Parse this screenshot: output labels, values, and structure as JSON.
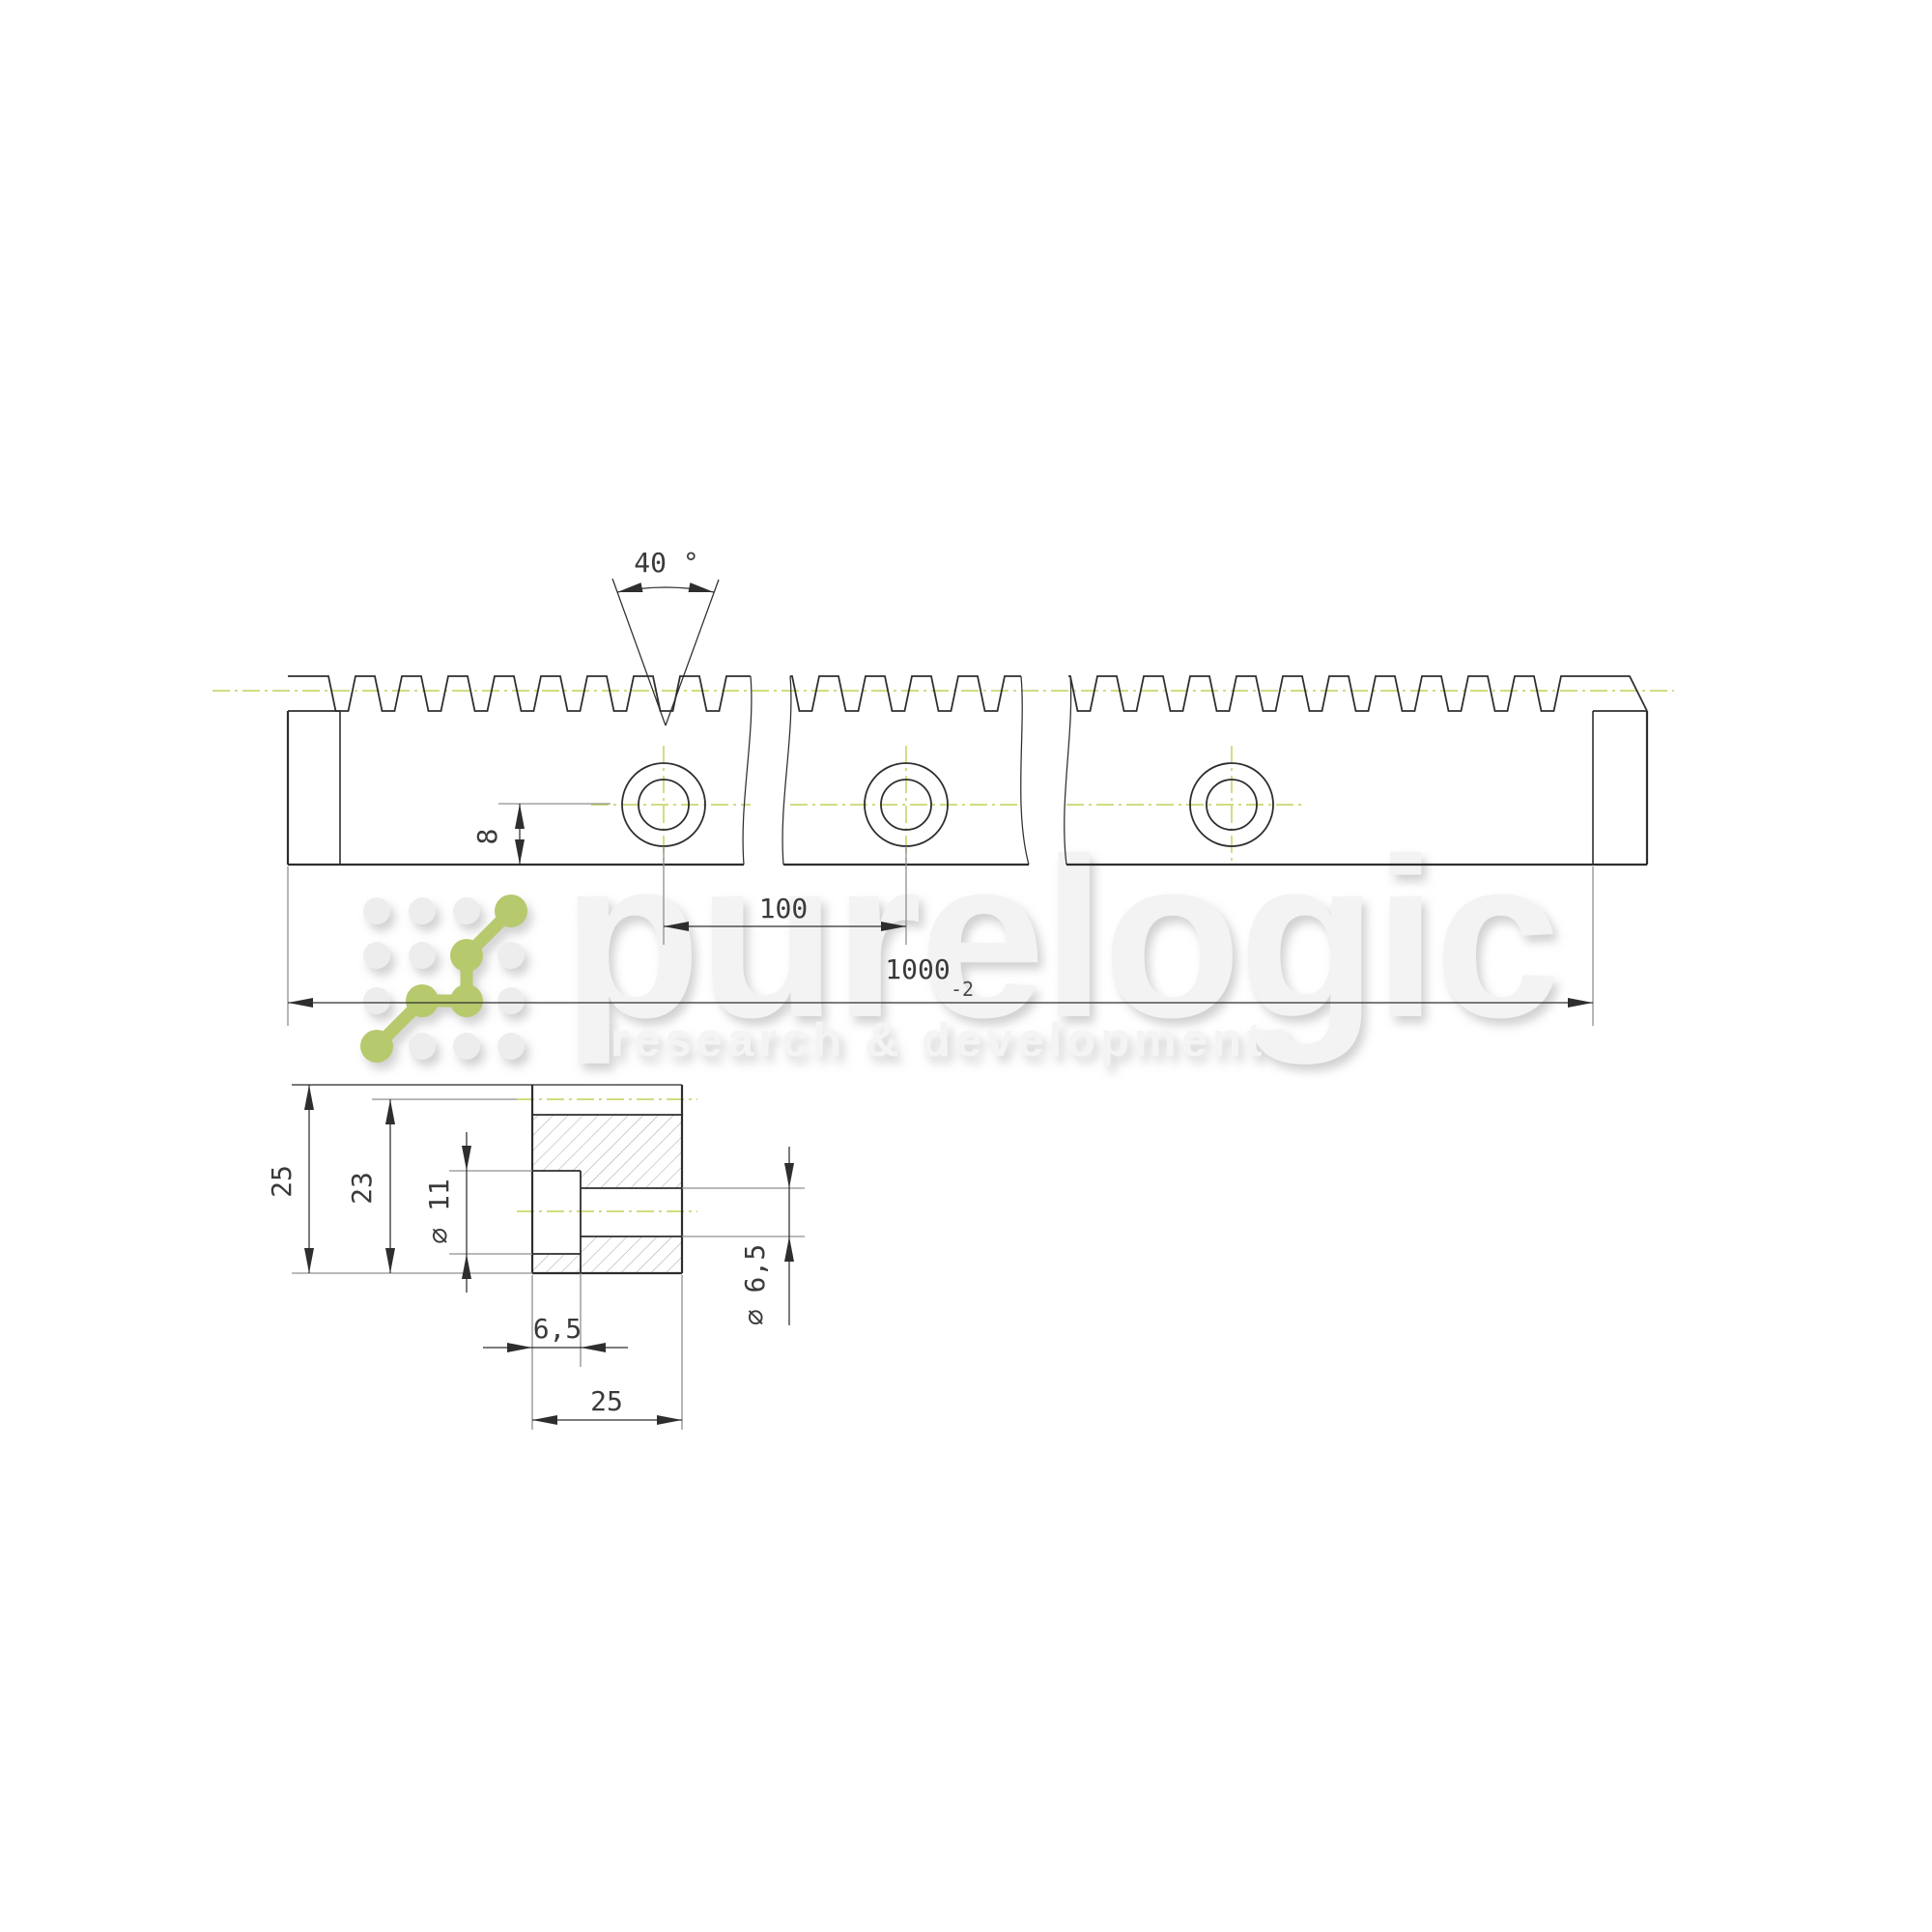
{
  "dims": {
    "tooth_angle": "40 °",
    "hole_offset": "8",
    "hole_spacing": "100",
    "total_length": "1000",
    "total_length_tol": "-2",
    "section_height": "25",
    "tooth_base_height": "23",
    "counterbore_dia": "⌀ 11",
    "through_hole_dia": "⌀ 6,5",
    "counterbore_depth": "6,5",
    "section_width": "25"
  },
  "watermark": {
    "brand": "purelogic",
    "tagline": "research & development"
  },
  "colors": {
    "line": "#2e2e2e",
    "thin": "#8f8f8f",
    "centerline": "#ccd76f",
    "accent-green": "#b7c96d",
    "watermark-fill": "#f3f3f3",
    "hatch": "#a3a3a3"
  }
}
